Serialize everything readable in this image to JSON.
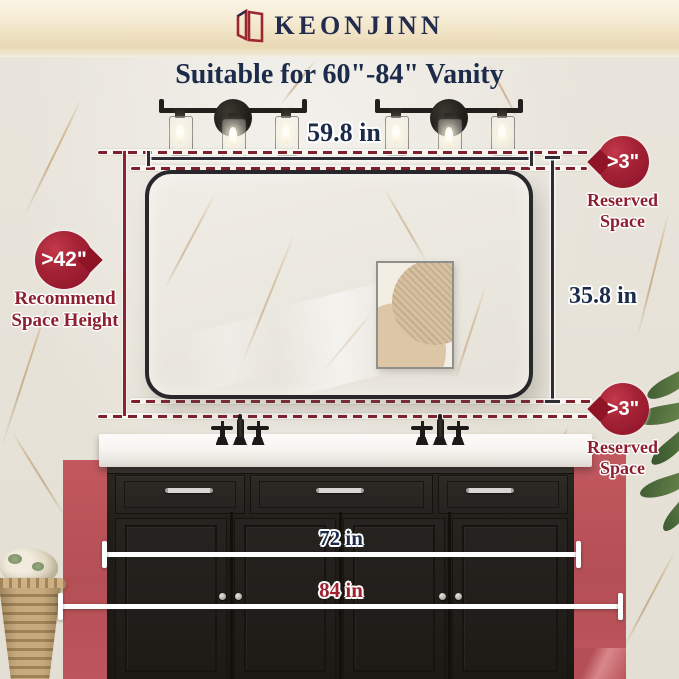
{
  "brand": {
    "name": "KEONJINN",
    "logo_icon": "double-mirror-logo",
    "logo_color": "#9b2731",
    "text_color": "#232c4e"
  },
  "title": {
    "text": "Suitable for 60\"-84\" Vanity"
  },
  "annotations": {
    "mirror_width_label": "59.8 in",
    "mirror_height_label": "35.8 in",
    "vanity_width_min_label": "72 in",
    "vanity_width_max_label": "84 in"
  },
  "badges": {
    "top_right": {
      "value": ">3\"",
      "label": [
        "Reserved",
        "Space"
      ]
    },
    "left": {
      "value": ">42\"",
      "label": [
        "Recommend",
        "Space Height"
      ]
    },
    "bottom_right": {
      "value": ">3\"",
      "label": [
        "Reserved",
        "Space"
      ]
    }
  },
  "colors": {
    "badge_red": "#9e1b30",
    "label_red": "#8e1f2e",
    "navy_text": "#1c2b4a",
    "wall_red": "#c05a60",
    "dash_red": "#7e1f2c",
    "top_band_cream": "#eedcb9"
  },
  "objects": {
    "lights": "two 3-light black vanity light fixtures",
    "mirror": "black rounded rectangle wall mirror",
    "artwork": "abstract beige framed print reflected in mirror",
    "vanity": "black double-sink vanity cabinet with white countertop",
    "faucets": "two black widespread cross-handle faucets",
    "basket": "wicker basket with fabric",
    "plant": "green plant leaves"
  }
}
